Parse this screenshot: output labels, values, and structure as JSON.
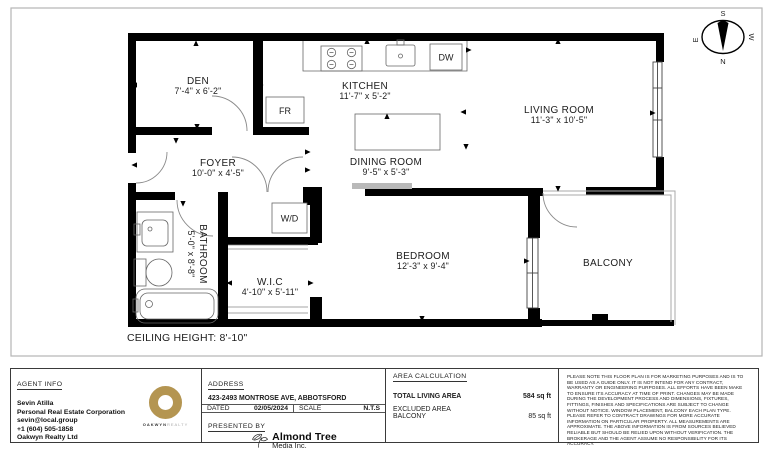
{
  "plan": {
    "rooms": [
      {
        "name": "DEN",
        "dims": "7'-4\" x 6'-2\""
      },
      {
        "name": "KITCHEN",
        "dims": "11'-7\" x 5'-2\""
      },
      {
        "name": "LIVING ROOM",
        "dims": "11'-3\" x 10'-5\""
      },
      {
        "name": "FOYER",
        "dims": "10'-0\" x 4'-5\""
      },
      {
        "name": "DINING ROOM",
        "dims": "9'-5\" x 5'-3\""
      },
      {
        "name": "BEDROOM",
        "dims": "12'-3\" x 9'-4\""
      },
      {
        "name": "W.I.C",
        "dims": "4'-10\" x 5'-11\""
      }
    ],
    "bathroom": {
      "name": "BATHROOM",
      "dims": "5'-0\" x 8'-8\""
    },
    "balcony_label": "BALCONY",
    "fixtures": {
      "fridge": "FR",
      "dishwasher": "DW",
      "washer_dryer": "W/D"
    },
    "ceiling_note": "CEILING HEIGHT: 8'-10\"",
    "compass": {
      "n": "N",
      "s": "S",
      "e": "E",
      "w": "W"
    }
  },
  "footer": {
    "agent": {
      "header": "AGENT INFO",
      "name": "Sevin Atilla",
      "title": "Personal Real Estate Corporation",
      "email": "sevin@local.group",
      "phone": "+1 (604) 505-1858",
      "brokerage": "Oakwyn Realty Ltd",
      "logo_word1": "OAKWYN",
      "logo_word2": "REALTY",
      "logo_color": "#b49551"
    },
    "address": {
      "header": "ADDRESS",
      "value": "423-2493 MONTROSE AVE, ABBOTSFORD",
      "dated_label": "DATED",
      "dated_value": "02/05/2024",
      "scale_label": "SCALE",
      "scale_value": "N.T.S",
      "presented_label": "PRESENTED BY",
      "media_name": "Almond Tree",
      "media_sub": "Media Inc."
    },
    "area_calculation": {
      "header": "AREA CALCULATION",
      "total_label": "TOTAL LIVING AREA",
      "total_value": "584 sq ft",
      "excluded_label": "EXCLUDED AREA",
      "balcony_label": "BALCONY",
      "balcony_value": "85 sq ft"
    },
    "disclaimer": "PLEASE NOTE THIS FLOOR PLAN IS FOR MARKETING PURPOSES AND IS TO BE USED AS A GUIDE ONLY. IT IS NOT INTEND FOR ANY CONTRACT, WARRANTY OR ENGINEERING PURPOSES. ALL EFFORTS HAVE BEEN MAKE TO ENSURE ITS ACCURACY AT TIME OF PRINT. CHANGES MAY BE MADE DURING THE DEVELOPMENT PROCESS AND DIMENSIONS, FIXTURES, FITTINGS, FINISHES AND SPECIFICATIONS ARE SUBJECT TO CHANGE WITHOUT NOTICE. WINDOW PLACEMENT, BALCONY EACH PLAN TYPE. PLEASE REFER TO CONTRACT DRAWINGS FOR MORE ACCURATE INFORMATION ON PARTICULAR PROPERTY. ALL MEASUREMENTS ARE APPROXIMATE. THE ABOVE INFORMATION IS FROM SOURCES BELIEVED RELIABLE BUT SHOULD BE RELIED UPON WITHOUT VERIFICATION. THE BROKERAGE AND THE AGENT ASSUME NO RESPONSIBILITY FOR ITS ACCURACY."
  }
}
